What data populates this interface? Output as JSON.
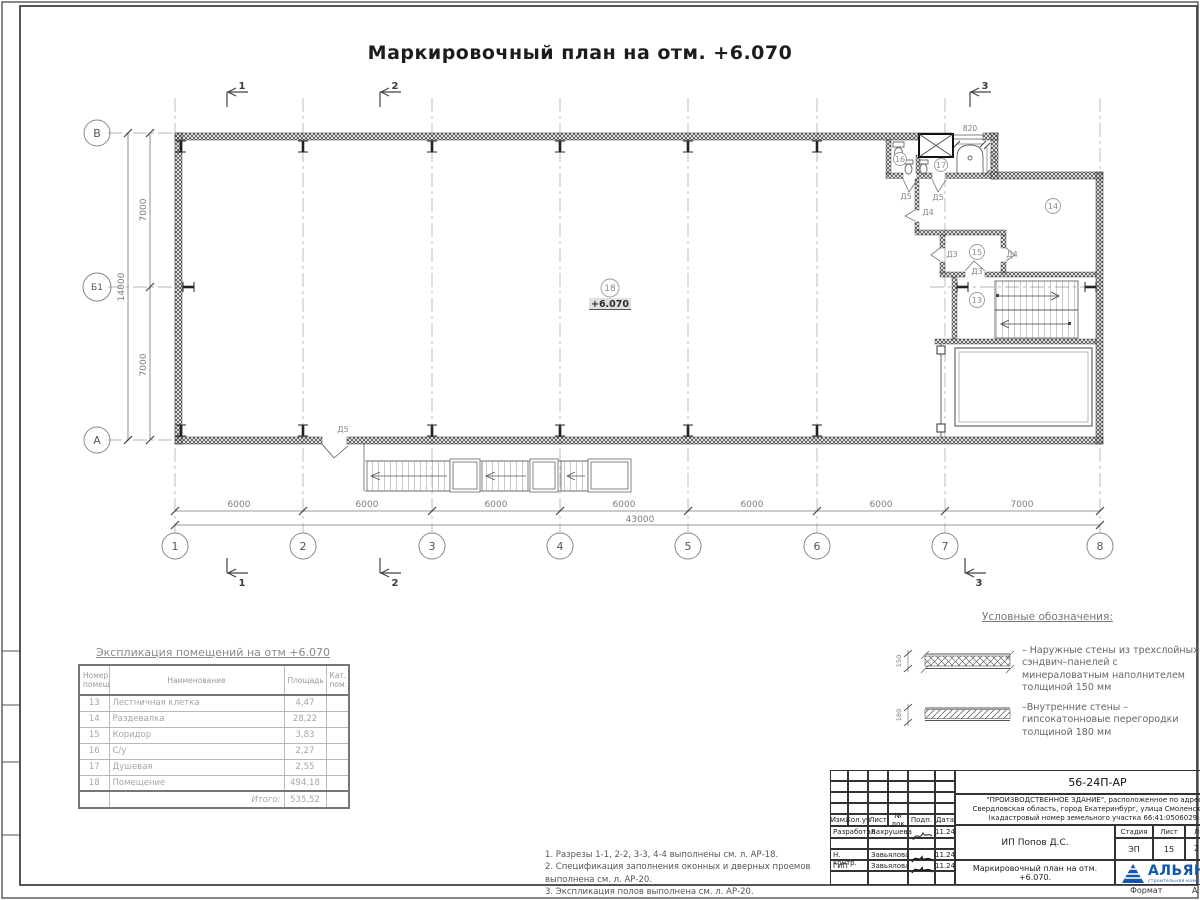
{
  "title": "Маркировочный план на отм. +6.070",
  "plan": {
    "elevation_mark": "+6.070",
    "axes_bottom": [
      "1",
      "2",
      "3",
      "4",
      "5",
      "6",
      "7",
      "8"
    ],
    "axes_left": [
      "В",
      "Б1",
      "А"
    ],
    "dims_bottom": [
      "6000",
      "6000",
      "6000",
      "6000",
      "6000",
      "6000",
      "7000"
    ],
    "dim_total_bottom": "43000",
    "dims_left": [
      "7000",
      "7000"
    ],
    "dim_total_left": "14000",
    "dim_opening_width": "820",
    "dim_room_depth": "1100",
    "rooms": [
      "13",
      "14",
      "15",
      "16",
      "17",
      "18"
    ],
    "doors": [
      "Д5",
      "Д5",
      "Д4",
      "Д3",
      "Д4",
      "Д3",
      "Д5"
    ],
    "sections": [
      "1",
      "2",
      "3"
    ]
  },
  "room_table": {
    "title": "Экспликация помещений на отм +6.070",
    "headers": [
      "Номер помещ.",
      "Наименование",
      "Площадь",
      "Кат. пом."
    ],
    "rows": [
      [
        "13",
        "Лестничная клетка",
        "4,47"
      ],
      [
        "14",
        "Раздевалка",
        "28,22"
      ],
      [
        "15",
        "Коридор",
        "3,83"
      ],
      [
        "16",
        "С/у",
        "2,27"
      ],
      [
        "17",
        "Душевая",
        "2,55"
      ],
      [
        "18",
        "Помещение",
        "494,18"
      ]
    ],
    "total_label": "Итого:",
    "total_value": "535,52"
  },
  "legend": {
    "title": "Условные обозначения:",
    "items": [
      {
        "thickness": "150",
        "text": "– Наружные стены из трехслойных сэндвич–панелей с минераловатным наполнителем толщиной 150 мм"
      },
      {
        "thickness": "180",
        "text": "–Внутренние стены – гипсокатонновые перегородки толщиной 180 мм"
      }
    ]
  },
  "notes": [
    "1. Разрезы 1-1, 2-2, 3-3, 4-4 выполнены см. л. АР-18.",
    "2. Спецификация заполнения оконных и дверных проемов выполнена см. л. АР-20.",
    "3. Экспликация полов выполнена см. л. АР-20."
  ],
  "title_block": {
    "code": "56-24П-АР",
    "project": "\"ПРОИЗВОДСТВЕННОЕ ЗДАНИЕ\", расположенное по адресу: Свердловская область, город Екатеринбург, улица Смоленская, 22 (кадастровый номер земельного участка 66:41:0506029:3)",
    "columns": [
      "Изм.",
      "Кол.уч",
      "Лист",
      "№ док",
      "Подп.",
      "Дата"
    ],
    "rows": [
      {
        "role": "Разработал",
        "name": "Вахрушева",
        "date": "11.24"
      },
      {
        "role": "Н. контр.",
        "name": "Завьялова",
        "date": "11.24"
      },
      {
        "role": "ГИП",
        "name": "Завьялова",
        "date": "11.24"
      }
    ],
    "client": "ИП Попов Д.С.",
    "sheet_title": "Маркировочный план на отм. +6.070.",
    "stage_label": "Стадия",
    "sheet_label": "Лист",
    "sheets_label": "Листов",
    "stage": "ЭП",
    "sheet": "15",
    "sheets": "2",
    "logo": {
      "name": "АЛЬЯНС",
      "tagline": "строительная компания"
    },
    "format_label": "Формат",
    "format_value": "А"
  }
}
